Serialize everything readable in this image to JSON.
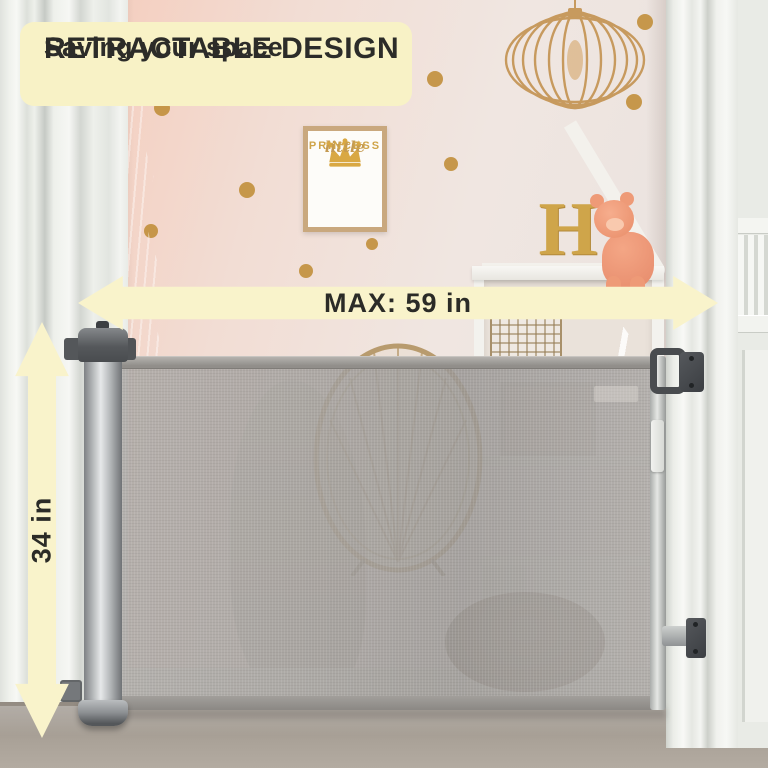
{
  "banner": {
    "title": "RETRACTABLE DESIGN",
    "subtitle": "Saving your space"
  },
  "measurements": {
    "width_label": "MAX: 59 in",
    "height_label": "34 in"
  },
  "wall_art": {
    "script_word": "little",
    "name_word": "PRINCESS",
    "stars": "★ ★ ★"
  },
  "shelf": {
    "letter": "H"
  },
  "colors": {
    "annotation_background": "#f8f2c6",
    "annotation_text": "#2c2c29",
    "gold_accent": "#c2903e",
    "mesh_gray": "#a6a39f",
    "curtain_peach": "#f19a79",
    "teepee_orange": "#e57c42",
    "crown_gold": "#d9a843"
  }
}
